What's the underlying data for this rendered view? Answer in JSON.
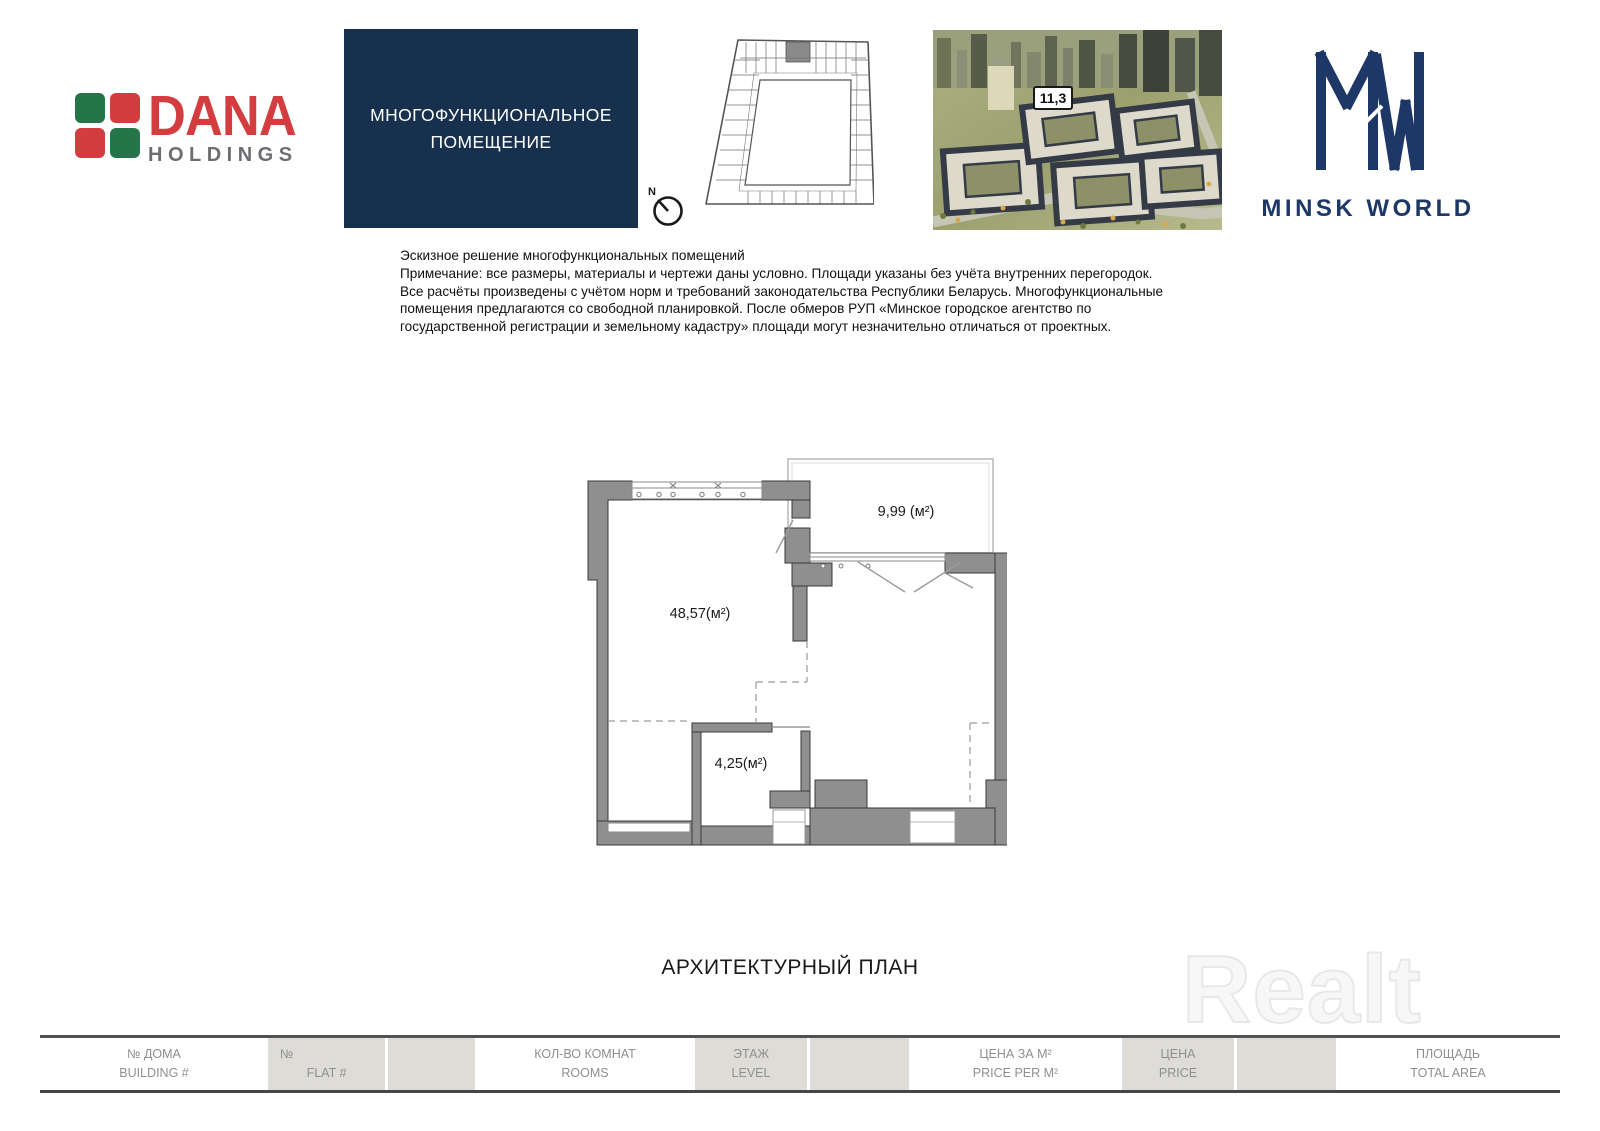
{
  "brand": {
    "dana": {
      "name": "DANA",
      "sub": "HOLDINGS",
      "green": "#26744a",
      "red": "#d43d3f",
      "gray": "#6d6e71"
    },
    "unit_box": {
      "line1": "МНОГОФУНКЦИОНАЛЬНОЕ",
      "line2": "ПОМЕЩЕНИЕ",
      "bg": "#16304d"
    },
    "minsk_world": {
      "name": "MINSK WORLD",
      "navy": "#1d3766"
    }
  },
  "site_plan": {
    "compass_label": "N"
  },
  "aerial": {
    "block_badge": "11,3"
  },
  "disclaimer": {
    "lines": [
      "Эскизное решение многофункциональных помещений",
      "Примечание: все размеры, материалы и чертежи даны условно. Площади указаны без учёта внутренних перегородок.",
      "Все расчёты произведены с учётом норм и требований законодательства Республики Беларусь. Многофункциональные",
      "помещения предлагаются со свободной планировкой. После обмеров РУП «Минское городское агентство по",
      "государственной регистрации и земельному кадастру» площади могут незначительно отличаться от проектных."
    ]
  },
  "floor_plan": {
    "wall_color": "#8f8f8f",
    "rooms": [
      {
        "name": "main-room",
        "label": "48,57(м²)"
      },
      {
        "name": "terrace",
        "label": "9,99 (м²)"
      },
      {
        "name": "storage",
        "label": "4,25(м²)"
      }
    ]
  },
  "plan_title": "АРХИТЕКТУРНЫЙ ПЛАН",
  "watermark": "Realt",
  "footer": {
    "building": {
      "ru": "№ ДОМА",
      "en": "BUILDING #"
    },
    "flat": {
      "ru": "№",
      "en": "FLAT #"
    },
    "rooms": {
      "ru": "КОЛ-ВО КОМНАТ",
      "en": "ROOMS"
    },
    "level": {
      "ru": "ЭТАЖ",
      "en": "LEVEL"
    },
    "price_per_m2": {
      "ru": "ЦЕНА ЗА М²",
      "en": "PRICE PER M²"
    },
    "price": {
      "ru": "ЦЕНА",
      "en": "PRICE"
    },
    "total_area": {
      "ru": "ПЛОЩАДЬ",
      "en": "TOTAL AREA"
    }
  }
}
